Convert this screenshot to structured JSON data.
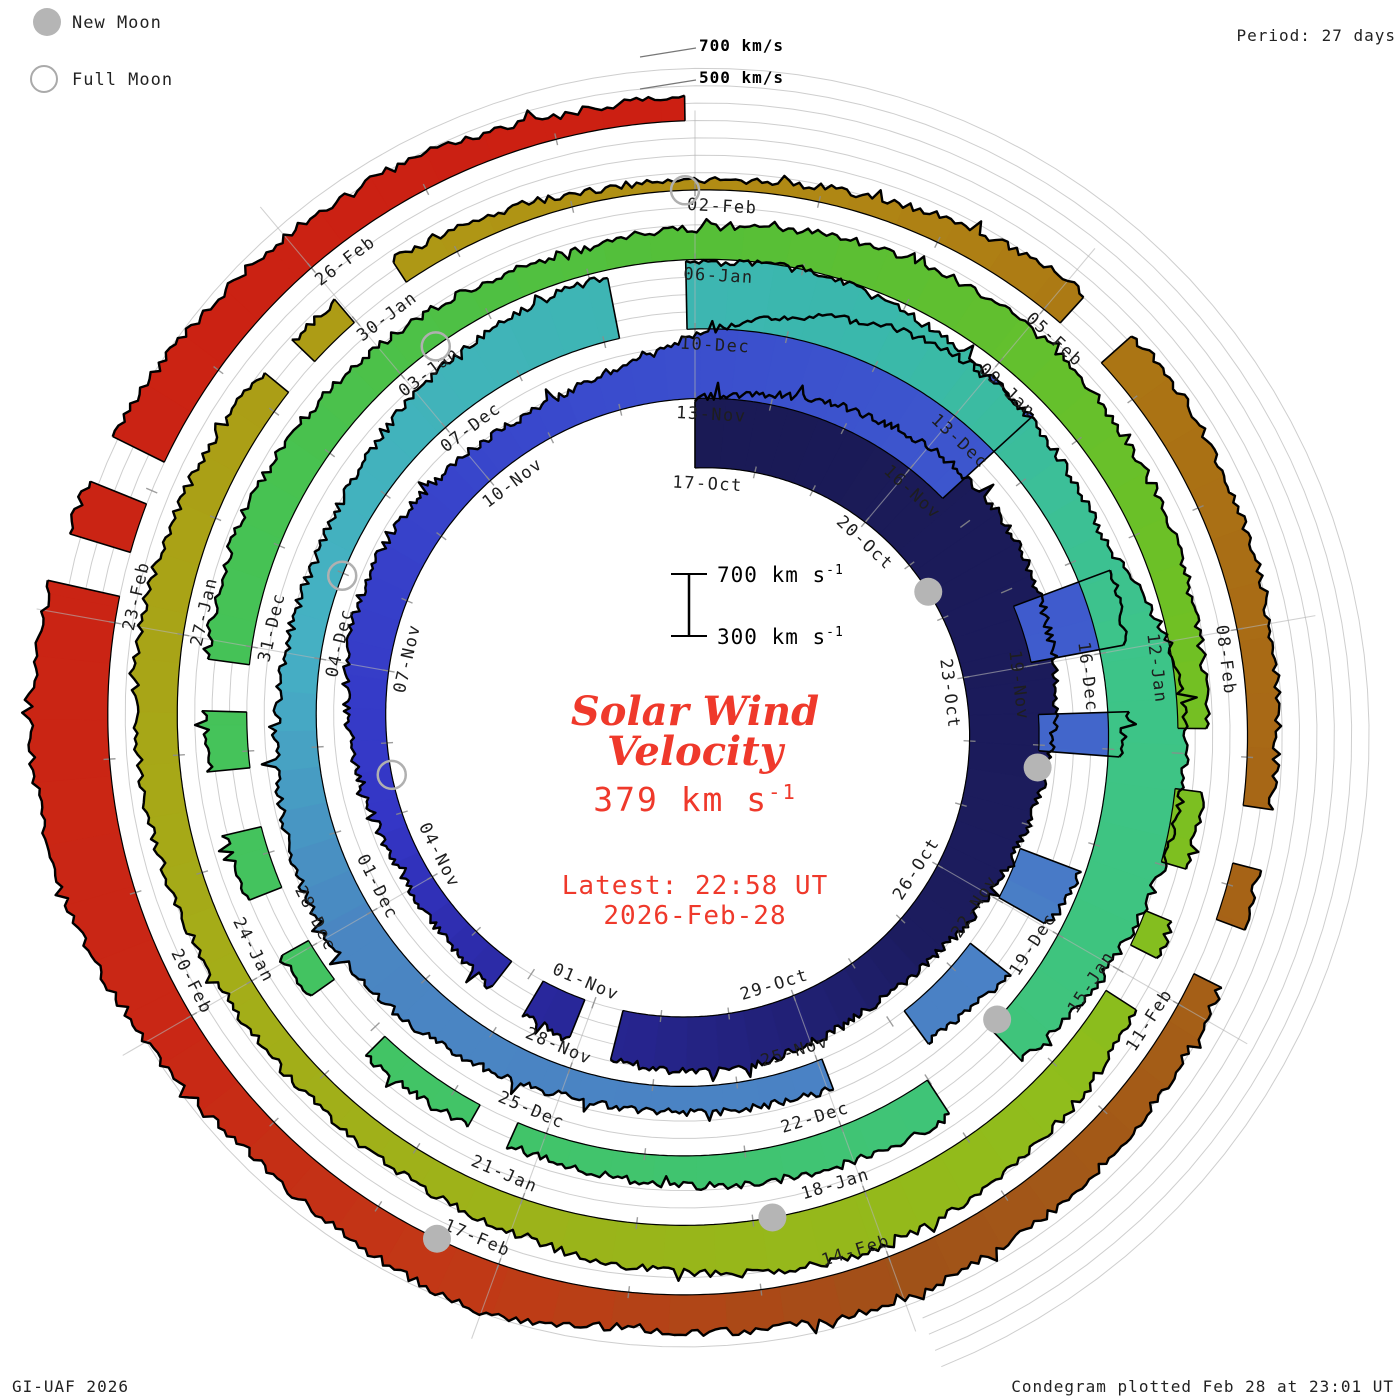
{
  "legend": {
    "new_moon": "New Moon",
    "full_moon": "Full Moon"
  },
  "period_label": "Period: 27 days",
  "credit": "GI-UAF 2026",
  "plotted_label": "Condegram plotted Feb 28 at 23:01 UT",
  "top_axis_labels": [
    "700 km/s",
    "500 km/s"
  ],
  "scale_bar": {
    "top": "700 km s",
    "bottom": "300 km s",
    "exp": "-1"
  },
  "center": {
    "title_line1": "Solar Wind",
    "title_line2": "Velocity",
    "speed_value": "379 km s",
    "speed_exp": "-1",
    "latest_line1": "Latest: 22:58 UT",
    "latest_line2": "2026-Feb-28"
  },
  "chart_data": {
    "type": "area",
    "kind": "condegram-spiral",
    "title": "Solar Wind Velocity",
    "start_date": "2025-10-17",
    "end_date": "2026-02-28",
    "latest_velocity_kms": 379,
    "latest_time_ut": "22:58 UT",
    "plotted_time_ut": "Feb 28 at 23:01 UT",
    "period_days": 27,
    "rotations": 5,
    "spoke_step_days": 3,
    "spokes_per_rotation": 9,
    "velocity_axis": {
      "min_kms": 300,
      "max_kms": 700,
      "grid_step_kms": 100
    },
    "date_labels": [
      {
        "day": 0,
        "label": "17-Oct"
      },
      {
        "day": 3,
        "label": "20-Oct"
      },
      {
        "day": 6,
        "label": "23-Oct"
      },
      {
        "day": 9,
        "label": "26-Oct"
      },
      {
        "day": 12,
        "label": "29-Oct"
      },
      {
        "day": 15,
        "label": "01-Nov"
      },
      {
        "day": 18,
        "label": "04-Nov"
      },
      {
        "day": 21,
        "label": "07-Nov"
      },
      {
        "day": 24,
        "label": "10-Nov"
      },
      {
        "day": 27,
        "label": "13-Nov"
      },
      {
        "day": 30,
        "label": "16-Nov"
      },
      {
        "day": 33,
        "label": "19-Nov"
      },
      {
        "day": 36,
        "label": "22-Nov"
      },
      {
        "day": 39,
        "label": "25-Nov"
      },
      {
        "day": 42,
        "label": "28-Nov"
      },
      {
        "day": 45,
        "label": "01-Dec"
      },
      {
        "day": 48,
        "label": "04-Dec"
      },
      {
        "day": 51,
        "label": "07-Dec"
      },
      {
        "day": 54,
        "label": "10-Dec"
      },
      {
        "day": 57,
        "label": "13-Dec"
      },
      {
        "day": 60,
        "label": "16-Dec"
      },
      {
        "day": 63,
        "label": "19-Dec"
      },
      {
        "day": 66,
        "label": "22-Dec"
      },
      {
        "day": 69,
        "label": "25-Dec"
      },
      {
        "day": 72,
        "label": "28-Dec"
      },
      {
        "day": 75,
        "label": "31-Dec"
      },
      {
        "day": 78,
        "label": "03-Jan"
      },
      {
        "day": 81,
        "label": "06-Jan"
      },
      {
        "day": 84,
        "label": "09-Jan"
      },
      {
        "day": 87,
        "label": "12-Jan"
      },
      {
        "day": 90,
        "label": "15-Jan"
      },
      {
        "day": 93,
        "label": "18-Jan"
      },
      {
        "day": 96,
        "label": "21-Jan"
      },
      {
        "day": 99,
        "label": "24-Jan"
      },
      {
        "day": 102,
        "label": "27-Jan"
      },
      {
        "day": 105,
        "label": "30-Jan"
      },
      {
        "day": 108,
        "label": "02-Feb"
      },
      {
        "day": 111,
        "label": "05-Feb"
      },
      {
        "day": 114,
        "label": "08-Feb"
      },
      {
        "day": 117,
        "label": "11-Feb"
      },
      {
        "day": 120,
        "label": "14-Feb"
      },
      {
        "day": 123,
        "label": "17-Feb"
      },
      {
        "day": 126,
        "label": "20-Feb"
      },
      {
        "day": 129,
        "label": "23-Feb"
      },
      {
        "day": 132,
        "label": "26-Feb"
      }
    ],
    "daily_velocity_kms": [
      700,
      760,
      820,
      870,
      890,
      870,
      830,
      770,
      700,
      640,
      590,
      565,
      590,
      625,
      605,
      560,
      505,
      465,
      445,
      460,
      505,
      545,
      565,
      545,
      505,
      480,
      530,
      660,
      820,
      950,
      1000,
      975,
      915,
      845,
      775,
      700,
      620,
      555,
      505,
      475,
      455,
      445,
      465,
      505,
      560,
      605,
      580,
      540,
      505,
      475,
      505,
      560,
      620,
      660,
      680,
      700,
      660,
      605,
      565,
      530,
      700,
      755,
      715,
      645,
      575,
      545,
      515,
      485,
      460,
      440,
      432,
      455,
      482,
      512,
      532,
      552,
      562,
      542,
      505,
      475,
      452,
      482,
      522,
      552,
      572,
      542,
      512,
      482,
      462,
      442,
      492,
      552,
      602,
      642,
      602,
      552,
      505,
      472,
      452,
      472,
      502,
      532,
      552,
      522,
      492,
      462,
      432,
      372,
      352,
      385,
      445,
      510,
      545,
      520,
      490,
      465,
      452,
      478,
      508,
      538,
      558,
      528,
      498,
      598,
      545,
      520,
      600,
      690,
      745,
      715,
      648,
      578,
      532,
      492,
      430
    ],
    "data_gaps_days": [
      [
        14.6,
        15.1
      ],
      [
        15.8,
        16.3
      ],
      [
        30.6,
        32.2
      ],
      [
        33.0,
        33.6
      ],
      [
        34.1,
        35.3
      ],
      [
        36.0,
        36.6
      ],
      [
        37.8,
        38.9
      ],
      [
        53.2,
        53.9
      ],
      [
        64.2,
        65.0
      ],
      [
        69.3,
        69.7
      ],
      [
        70.9,
        71.6
      ],
      [
        72.1,
        72.6
      ],
      [
        73.3,
        73.8
      ],
      [
        74.4,
        74.8
      ],
      [
        87.8,
        88.3
      ],
      [
        89.0,
        89.4
      ],
      [
        89.8,
        90.2
      ],
      [
        104.2,
        104.5
      ],
      [
        105.0,
        105.5
      ],
      [
        111.2,
        111.6
      ],
      [
        115.4,
        115.8
      ],
      [
        116.3,
        116.7
      ],
      [
        129.2,
        129.5
      ],
      [
        129.9,
        130.2
      ]
    ],
    "color_stops": [
      [
        0,
        "#1a1a55"
      ],
      [
        10,
        "#1c1c5e"
      ],
      [
        16,
        "#2a28a0"
      ],
      [
        19,
        "#3436c6"
      ],
      [
        26,
        "#3a4ccd"
      ],
      [
        33,
        "#3f5ccd"
      ],
      [
        36,
        "#4a80c6"
      ],
      [
        45,
        "#4a86c2"
      ],
      [
        48,
        "#45b0c4"
      ],
      [
        56,
        "#3ab8ab"
      ],
      [
        60,
        "#3dc489"
      ],
      [
        69,
        "#41c46a"
      ],
      [
        76,
        "#46c254"
      ],
      [
        81,
        "#55bf38"
      ],
      [
        87,
        "#70c024"
      ],
      [
        91,
        "#8fbd1c"
      ],
      [
        99,
        "#a4ad18"
      ],
      [
        105,
        "#ad9b15"
      ],
      [
        108,
        "#b18d14"
      ],
      [
        112,
        "#ab7414"
      ],
      [
        117,
        "#a55f17"
      ],
      [
        120,
        "#a05118"
      ],
      [
        123,
        "#c03a16"
      ],
      [
        126,
        "#c92715"
      ],
      [
        135,
        "#cc1f12"
      ]
    ],
    "moons": [
      {
        "phase": "new",
        "date": "2025-10-21",
        "day": 4.52
      },
      {
        "phase": "full",
        "date": "2025-11-05",
        "day": 19.55
      },
      {
        "phase": "new",
        "date": "2025-11-20",
        "day": 34.28
      },
      {
        "phase": "full",
        "date": "2025-12-04",
        "day": 48.97
      },
      {
        "phase": "new",
        "date": "2025-12-20",
        "day": 64.07
      },
      {
        "phase": "full",
        "date": "2026-01-03",
        "day": 78.42
      },
      {
        "phase": "new",
        "date": "2026-01-18",
        "day": 93.83
      },
      {
        "phase": "full",
        "date": "2026-02-01",
        "day": 107.92
      },
      {
        "phase": "new",
        "date": "2026-02-17",
        "day": 123.5
      }
    ],
    "style": {
      "grid_color": "#c9c9c9",
      "spoke_color": "#b4b4b4",
      "tick_color": "#8c8c8c",
      "trace_color": "#000000",
      "moon_gray": "#b5b5b5",
      "annotation_red": "#ef392b"
    }
  }
}
